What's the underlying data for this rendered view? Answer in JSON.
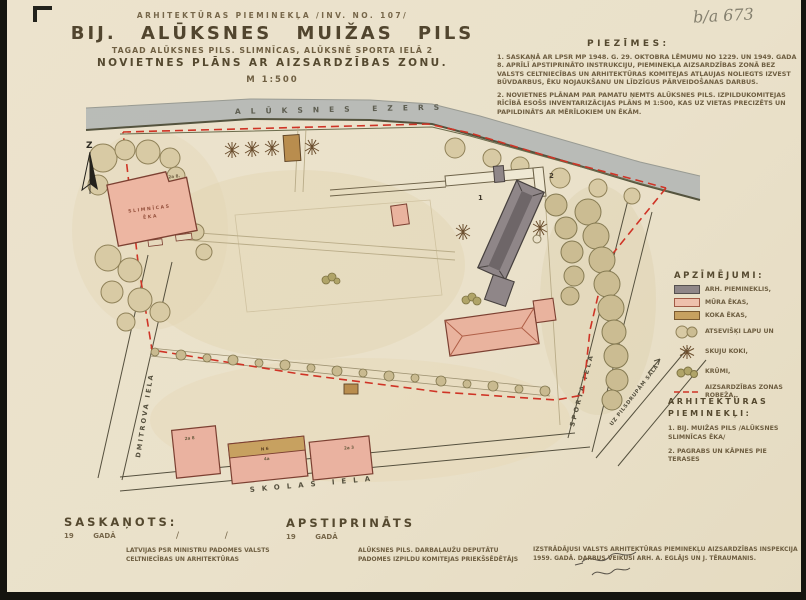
{
  "colors": {
    "paper": "#eae1ca",
    "ink": "#6a5a3e",
    "red_boundary": "#cf3426",
    "masonry_pink": "#e9b39e",
    "monument_gray": "#8f8688",
    "wood_tan": "#c7a160",
    "lake_gray": "#b4b7b5"
  },
  "annotation": {
    "archive_no": "b/a 673"
  },
  "header": {
    "line1": "ARHITEKTŪRAS PIEMINEKĻA /INV. NO. 107/",
    "title": "BIJ. ALŪKSNES MUIŽAS PILS",
    "line3": "TAGAD ALŪKSNES PILS. SLIMNĪCAS, ALŪKSNĒ SPORTA IELĀ 2",
    "line4": "NOVIETNES PLĀNS AR AIZSARDZĪBAS ZONU.",
    "scale": "M 1:500"
  },
  "notes": {
    "heading": "PIEZĪMES:",
    "items": [
      "1. SASKAŅĀ AR LPSR MP 1948. G. 29. OKTOBRA LĒMUMU NO 1229. UN 1949. GADA 8. APRĪLĪ APSTIPRINĀTO INSTRUKCIJU, PIEMINEKĻA AIZSARDZĪBAS ZONĀ BEZ VALSTS CELTNIECĪBAS UN ARHITEKTŪRAS KOMITEJAS ATĻAUJAS NOLIEGTS IZVEST BŪVDARBUS, ĒKU NOJAUKŠANU UN LĪDZĪGUS PĀRVEIDOŠANAS DARBUS.",
      "2. NOVIETNES PLĀNAM PAR PAMATU ŅEMTS ALŪKSNES PILS. IZPILDUKOMITEJAS RĪCĪBĀ ESOŠS INVENTARIZĀCIJAS PLĀNS M 1:500, KAS UZ VIETAS PRECIZĒTS UN PAPILDINĀTS AR MĒRĪLOKIEM UN ĒKĀM."
    ]
  },
  "map": {
    "lake_label": "ALŪKSNES   EZERS",
    "north_label": "Z",
    "streets": {
      "left": "DMITROVA  IELA",
      "bottom": "SKOLAS  IELA",
      "right": "SPORTA  IELA",
      "corner": "UZ PILSDRUPĀM SALĀ"
    },
    "markers": {
      "palace": "1",
      "cellar": "2"
    },
    "hospital": {
      "line1": "SLIMNĪCAS",
      "line2": "ĒKA",
      "corner_no": "2a 8."
    },
    "bottom_building_labels": [
      "2a 8",
      "N 6",
      "4a",
      "2a 3"
    ]
  },
  "legend": {
    "heading": "APZĪMĒJUMI:",
    "items": [
      {
        "label": "ARH. PIEMINEKLIS,"
      },
      {
        "label": "MŪRA ĒKAS,"
      },
      {
        "label": "KOKA ĒKAS,"
      },
      {
        "label": "ATSEVIŠĶI LAPU UN"
      },
      {
        "label": "SKUJU KOKI,"
      },
      {
        "label": "KRŪMI,"
      },
      {
        "label": "AIZSARDZĪBAS ZONAS ROBEŽA,"
      }
    ]
  },
  "monuments": {
    "heading": "ARHITEKTŪRAS PIEMINEKĻI:",
    "items": [
      "1. BIJ. MUIŽAS PILS /ALŪKSNES SLIMNĪCAS ĒKA/",
      "2. PAGRABS UN KĀPNES PIE TERASES"
    ]
  },
  "footer": {
    "agreed_label": "SASKAŅOTS:",
    "agreed_year": "19        GADĀ",
    "approved_label": "APSTIPRINĀTS",
    "approved_year": "19        GADĀ",
    "slash_line": "/                /",
    "org_left_line1": "LATVIJAS PSR MINISTRU PADOMES VALSTS",
    "org_left_line2": "CELTNIECĪBAS UN ARHITEKTŪRAS",
    "org_center_line1": "ALŪKSNES PILS. DARBAĻAUŽU DEPUTĀTU",
    "org_center_line2": "PADOMES IZPILDU KOMITEJAS PRIEKŠSĒDĒTĀJS",
    "credit_line1": "IZSTRĀDĀJUSI VALSTS ARHITEKTŪRAS PIEMINEKĻU AIZSARDZĪBAS INSPEKCIJA",
    "credit_line2": "1959. GADĀ. DARBUS VEIKUŠI ARH. A. EGLĀJS UN J. TĒRAUMANIS."
  }
}
